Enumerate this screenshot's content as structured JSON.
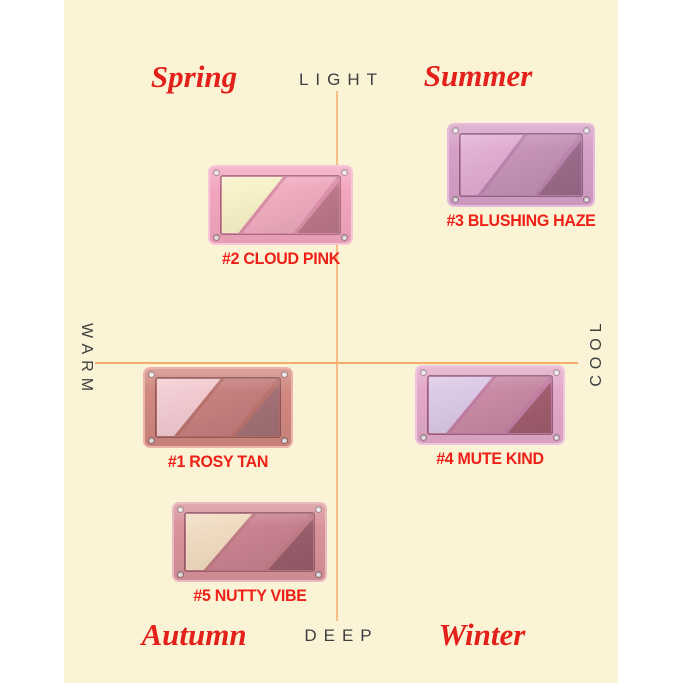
{
  "canvas": {
    "page_bg": "#ffffff",
    "panel_bg": "#faf3d6"
  },
  "axes": {
    "top": "LIGHT",
    "bottom": "DEEP",
    "left": "WARM",
    "right": "COOL",
    "caption_color": "#3e3e3e",
    "h_line_color": "#f6ad68",
    "v_line_color": "#f8bd86"
  },
  "quadrants": {
    "top_left": "Spring",
    "top_right": "Summer",
    "bottom_left": "Autumn",
    "bottom_right": "Winter",
    "color": "#e3201a"
  },
  "palette_label_color": "#ee2017",
  "palettes": [
    {
      "number": "#1",
      "name": "ROSY TAN",
      "label": "#1 ROSY TAN",
      "position": "warm-deep (center-left, Autumn side)",
      "frame_color": "#d0887f",
      "edge_color": "#eab4ab",
      "recess_color": "#b9736d",
      "shade_colors": [
        "#f0c7ce",
        "#c67f7f",
        "#a87478"
      ]
    },
    {
      "number": "#2",
      "name": "CLOUD PINK",
      "label": "#2 CLOUD PINK",
      "position": "warm-light (Spring quadrant)",
      "frame_color": "#f2a6bd",
      "edge_color": "#f8c6d6",
      "recess_color": "#db90a9",
      "shade_colors": [
        "#f7f0c4",
        "#f0acc0",
        "#c17b8d"
      ]
    },
    {
      "number": "#3",
      "name": "BLUSHING HAZE",
      "label": "#3 BLUSHING HAZE",
      "position": "cool-light (Summer quadrant)",
      "frame_color": "#d7a0c7",
      "edge_color": "#e5bcd9",
      "recess_color": "#bb84ad",
      "shade_colors": [
        "#dfa8ce",
        "#c693b5",
        "#a06e8e"
      ]
    },
    {
      "number": "#4",
      "name": "MUTE KIND",
      "label": "#4 MUTE KIND",
      "position": "cool-deep (Winter side, near axis)",
      "frame_color": "#e3a9c9",
      "edge_color": "#f0c6dd",
      "recess_color": "#c17ea3",
      "shade_colors": [
        "#d9c5e4",
        "#c98aa5",
        "#a56072"
      ]
    },
    {
      "number": "#5",
      "name": "NUTTY VIBE",
      "label": "#5 NUTTY VIBE",
      "position": "warm-deep (Autumn quadrant, deepest)",
      "frame_color": "#d8939a",
      "edge_color": "#e9babe",
      "recess_color": "#c07b85",
      "shade_colors": [
        "#efd9bd",
        "#c98290",
        "#9d5f6e"
      ]
    }
  ]
}
